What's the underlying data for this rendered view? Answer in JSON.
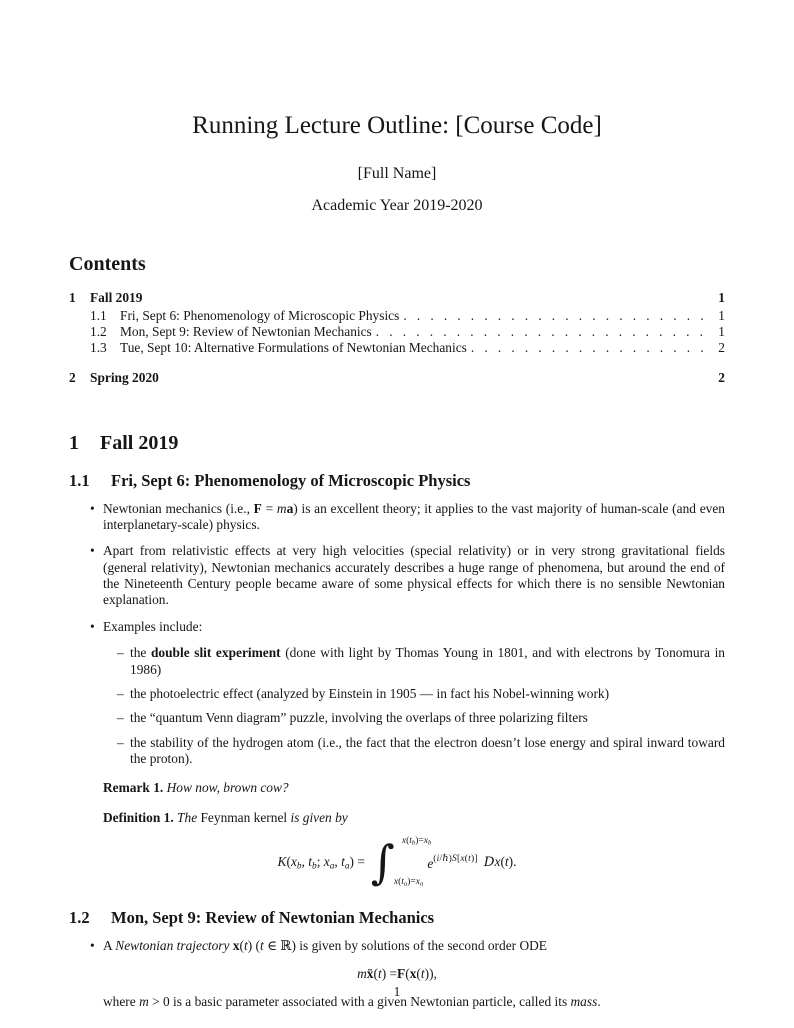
{
  "doc": {
    "title": "Running Lecture Outline: [Course Code]",
    "author": "[Full Name]",
    "date": "Academic Year 2019-2020",
    "footer_page_number": "1"
  },
  "contents": {
    "heading": "Contents",
    "entries": [
      {
        "number": "1",
        "label": "Fall 2019",
        "page": "1"
      },
      {
        "number": "1.1",
        "label": "Fri, Sept 6: Phenomenology of Microscopic Physics",
        "page": "1"
      },
      {
        "number": "1.2",
        "label": "Mon, Sept 9: Review of Newtonian Mechanics",
        "page": "1"
      },
      {
        "number": "1.3",
        "label": "Tue, Sept 10: Alternative Formulations of Newtonian Mechanics",
        "page": "2"
      },
      {
        "number": "2",
        "label": "Spring 2020",
        "page": "2"
      }
    ]
  },
  "section1": {
    "number": "1",
    "title": "Fall 2019"
  },
  "section11": {
    "number": "1.1",
    "title": "Fri, Sept 6: Phenomenology of Microscopic Physics",
    "bullet1": [
      {
        "t": "Newtonian mechanics (i.e., "
      },
      {
        "t": "F",
        "s": "mb"
      },
      {
        "t": " = "
      },
      {
        "t": "m",
        "s": "m"
      },
      {
        "t": "a",
        "s": "mb"
      },
      {
        "t": ") is an excellent theory; it applies to the vast majority of human-scale (and even interplanetary-scale) physics."
      }
    ],
    "bullet2": [
      {
        "t": "Apart from relativistic effects at very high velocities (special relativity) or in very strong gravitational fields (general relativity), Newtonian mechanics accurately describes a huge range of phenomena, but around the end of the Nineteenth Century people became aware of some physical effects for which there is no sensible Newtonian explanation."
      }
    ],
    "bullet3": [
      {
        "t": "Examples include:"
      }
    ],
    "example1": [
      {
        "t": "the "
      },
      {
        "t": "double slit experiment",
        "s": "b"
      },
      {
        "t": " (done with light by Thomas Young in 1801, and with electrons by Tonomura in 1986)"
      }
    ],
    "example2": [
      {
        "t": "the photoelectric effect (analyzed by Einstein in 1905 — in fact his Nobel-winning work)"
      }
    ],
    "example3": [
      {
        "t": "the “quantum Venn diagram” puzzle, involving the overlaps of three polarizing filters"
      }
    ],
    "example4": [
      {
        "t": "the stability of the hydrogen atom (i.e., the fact that the electron doesn’t lose energy and spiral inward toward the proton)."
      }
    ],
    "remark": {
      "label": "Remark 1.",
      "body": [
        {
          "t": "How now, brown cow?",
          "s": "i"
        }
      ]
    },
    "definition": {
      "label": "Definition 1.",
      "body": [
        {
          "t": "The ",
          "s": "i"
        },
        {
          "t": "Feynman kernel"
        },
        {
          "t": " is given by",
          "s": "i"
        }
      ]
    },
    "formula": {
      "int_sign": "∫",
      "lhs": [
        {
          "t": "K",
          "s": "m"
        },
        {
          "t": "("
        },
        {
          "t": "x",
          "s": "m"
        },
        {
          "t": "b",
          "s": "msub"
        },
        {
          "t": ", "
        },
        {
          "t": "t",
          "s": "m"
        },
        {
          "t": "b",
          "s": "msub"
        },
        {
          "t": "; "
        },
        {
          "t": "x",
          "s": "m"
        },
        {
          "t": "a",
          "s": "msub"
        },
        {
          "t": ", "
        },
        {
          "t": "t",
          "s": "m"
        },
        {
          "t": "a",
          "s": "msub"
        },
        {
          "t": ") = "
        }
      ],
      "int_upper": [
        {
          "t": "x",
          "s": "m"
        },
        {
          "t": "("
        },
        {
          "t": "t",
          "s": "m"
        },
        {
          "t": "b",
          "s": "msub"
        },
        {
          "t": ")="
        },
        {
          "t": "x",
          "s": "m"
        },
        {
          "t": "b",
          "s": "msub"
        }
      ],
      "int_lower": [
        {
          "t": "x",
          "s": "m"
        },
        {
          "t": "("
        },
        {
          "t": "t",
          "s": "m"
        },
        {
          "t": "a",
          "s": "msub"
        },
        {
          "t": ")="
        },
        {
          "t": "x",
          "s": "m"
        },
        {
          "t": "a",
          "s": "msub"
        }
      ],
      "exp_base": [
        {
          "t": "e",
          "s": "m"
        }
      ],
      "exp_sup": [
        {
          "t": "("
        },
        {
          "t": "i",
          "s": "m"
        },
        {
          "t": "/"
        },
        {
          "t": "ℏ",
          "s": "m"
        },
        {
          "t": ")"
        },
        {
          "t": "S",
          "s": "m"
        },
        {
          "t": "["
        },
        {
          "t": "x",
          "s": "m"
        },
        {
          "t": "("
        },
        {
          "t": "t",
          "s": "m"
        },
        {
          "t": ")]"
        }
      ],
      "tail": [
        {
          "t": "D",
          "s": "scr"
        },
        {
          "t": "x",
          "s": "m"
        },
        {
          "t": "("
        },
        {
          "t": "t",
          "s": "m"
        },
        {
          "t": ")."
        }
      ]
    }
  },
  "section12": {
    "number": "1.2",
    "title": "Mon, Sept 9: Review of Newtonian Mechanics",
    "bullet1": [
      {
        "t": "A "
      },
      {
        "t": "Newtonian trajectory",
        "s": "i"
      },
      {
        "t": " "
      },
      {
        "t": "x",
        "s": "mb"
      },
      {
        "t": "("
      },
      {
        "t": "t",
        "s": "m"
      },
      {
        "t": ") ("
      },
      {
        "t": "t",
        "s": "m"
      },
      {
        "t": " ∈ ℝ) is given by solutions of the second order ODE"
      }
    ],
    "formula": [
      {
        "t": "m",
        "s": "m"
      },
      {
        "t": " "
      },
      {
        "t": "ẍ",
        "s": "mb"
      },
      {
        "t": "("
      },
      {
        "t": "t",
        "s": "m"
      },
      {
        "t": ") = "
      },
      {
        "t": "F",
        "s": "mb"
      },
      {
        "t": "("
      },
      {
        "t": "x",
        "s": "mb"
      },
      {
        "t": "("
      },
      {
        "t": "t",
        "s": "m"
      },
      {
        "t": ")),"
      }
    ],
    "after_formula": [
      {
        "t": "where "
      },
      {
        "t": "m",
        "s": "m"
      },
      {
        "t": " > 0 is a basic parameter associated with a given Newtonian particle, called its "
      },
      {
        "t": "mass",
        "s": "i"
      },
      {
        "t": "."
      }
    ]
  }
}
